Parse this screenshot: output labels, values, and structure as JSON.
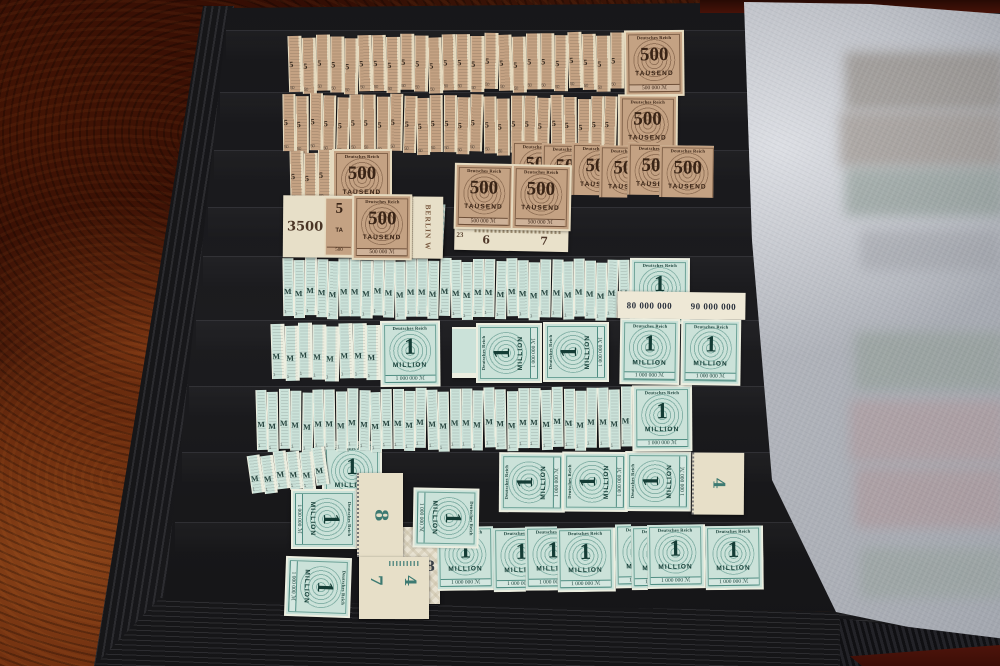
{
  "stamp_types": {
    "brown": {
      "header": "Deutsches Reich",
      "value": "500",
      "unit": "TAUSEND",
      "footer": "500 000 ℳ",
      "sliver_glyph": "5",
      "sliver_digit": "50"
    },
    "green": {
      "header": "Deutsches Reich",
      "value": "1",
      "unit": "MILLION",
      "footer": "1 000 000 ℳ",
      "sliver_glyph": "M",
      "sliver_digit": "1"
    }
  },
  "annotations": {
    "pencil_3500": "3500",
    "partial_value": "5",
    "partial_unit": "TA",
    "partial_footer": "500",
    "sheet_corner": "BERLIN W",
    "plate_23": "23",
    "plate_6": "6",
    "plate_7": "7",
    "sheet_80m": "80 000 000",
    "sheet_90m": "90 000 000",
    "plate_8": "8",
    "plate_7b": "7",
    "plate_4": "4",
    "plate_8b": "8",
    "plate_4b": "4"
  },
  "strips": [
    {
      "id": "row1-500t",
      "color": "brown",
      "x": 288,
      "y": 36,
      "h": 56,
      "slivers": 24,
      "step": 15,
      "full": true,
      "tilt": -0.6
    },
    {
      "id": "row2-500t",
      "color": "brown",
      "x": 283,
      "y": 94,
      "h": 57,
      "slivers": 25,
      "step": 14.4,
      "full": true,
      "tilt": 0.4
    },
    {
      "id": "row3-left-500t",
      "color": "brown",
      "x": 290,
      "y": 151,
      "h": 50,
      "slivers": 3,
      "step": 15,
      "full": true,
      "tilt": 0
    },
    {
      "id": "row3-right-500t",
      "color": "brown",
      "x": 512,
      "y": 141,
      "h": 52,
      "group": [
        30,
        30,
        28,
        28,
        32,
        54
      ],
      "tilt": 0.8
    },
    {
      "id": "row5-1m",
      "color": "green",
      "x": 283,
      "y": 258,
      "h": 58,
      "slivers": 31,
      "step": 12.2,
      "full": true,
      "tilt": 0.3
    },
    {
      "id": "row6-left-1m",
      "color": "green",
      "x": 271,
      "y": 324,
      "h": 55,
      "slivers": 8,
      "step": 14.6,
      "full": true,
      "tilt": -0.5
    },
    {
      "id": "row7-1m",
      "color": "green",
      "x": 256,
      "y": 390,
      "h": 60,
      "slivers": 33,
      "step": 12.4,
      "full": true,
      "tilt": -0.4
    },
    {
      "id": "row8-fan-1m",
      "color": "green",
      "x": 247,
      "y": 456,
      "h": 38,
      "slivers": 6,
      "step": 14,
      "full": false,
      "tilt": -7
    },
    {
      "id": "row9-bottom-1m",
      "color": "green",
      "x": 437,
      "y": 527,
      "h": 64,
      "group": [
        56,
        32,
        32,
        58,
        16,
        16,
        58,
        58
      ],
      "tilt": -0.8
    }
  ]
}
